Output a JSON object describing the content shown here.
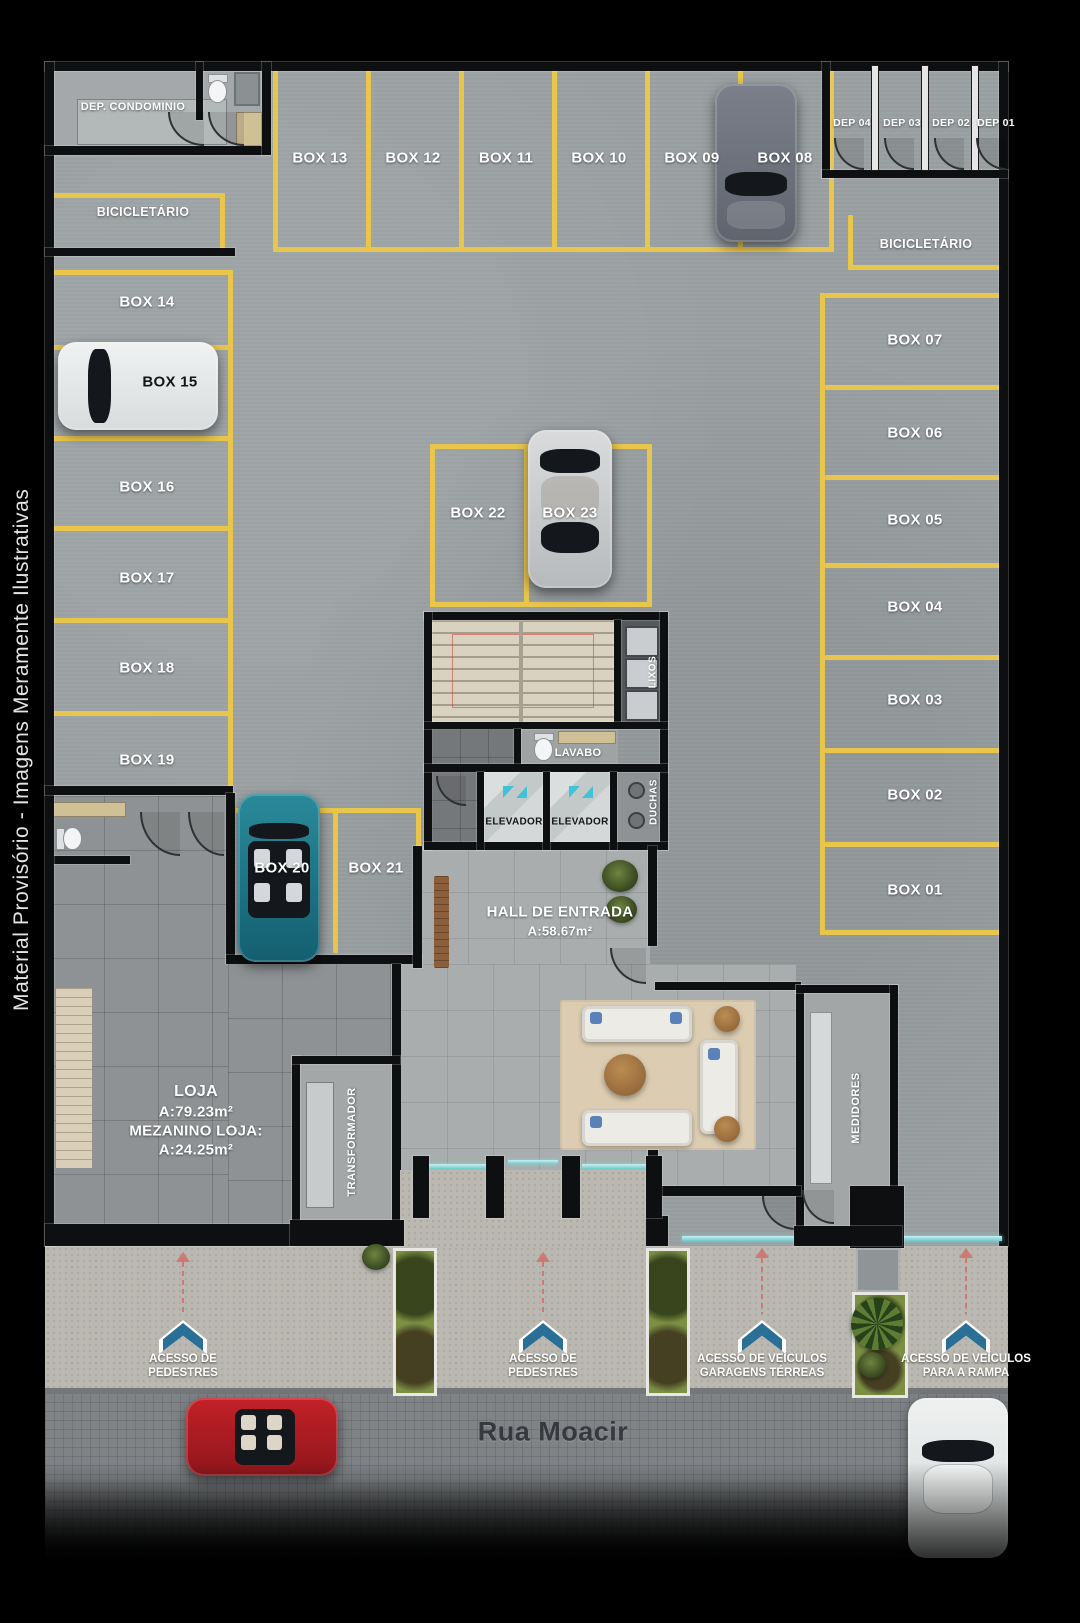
{
  "watermark": "Material Provisório - Imagens Meramente Ilustrativas",
  "street": {
    "name": "Rua Moacir"
  },
  "rooms": {
    "dep_condominio": "DEP. CONDOMINIO",
    "bicicletario_left": "BICICLETÁRIO",
    "bicicletario_right": "BICICLETÁRIO",
    "lixos": "LIXOS",
    "lavabo": "LAVABO",
    "elevador_left": "ELEVADOR",
    "elevador_right": "ELEVADOR",
    "duchas": "DUCHAS",
    "transformador": "TRANSFORMADOR",
    "medidores": "MEDIDORES",
    "hall_title": "HALL DE ENTRADA",
    "hall_area": "A:58.67m²",
    "loja_title": "LOJA",
    "loja_area": "A:79.23m²",
    "loja_mezanino": "MEZANINO LOJA:",
    "loja_mezanino_area": "A:24.25m²"
  },
  "deps": {
    "d04": "DEP 04",
    "d03": "DEP 03",
    "d02": "DEP 02",
    "d01": "DEP 01"
  },
  "boxes": {
    "b01": "BOX 01",
    "b02": "BOX 02",
    "b03": "BOX 03",
    "b04": "BOX 04",
    "b05": "BOX 05",
    "b06": "BOX 06",
    "b07": "BOX 07",
    "b08": "BOX 08",
    "b09": "BOX 09",
    "b10": "BOX 10",
    "b11": "BOX 11",
    "b12": "BOX 12",
    "b13": "BOX 13",
    "b14": "BOX 14",
    "b15": "BOX 15",
    "b16": "BOX 16",
    "b17": "BOX 17",
    "b18": "BOX 18",
    "b19": "BOX 19",
    "b20": "BOX 20",
    "b21": "BOX 21",
    "b22": "BOX 22",
    "b23": "BOX 23"
  },
  "accesses": {
    "ped1_l1": "ACESSO DE",
    "ped1_l2": "PEDESTRES",
    "ped2_l1": "ACESSO DE",
    "ped2_l2": "PEDESTRES",
    "veic1_l1": "ACESSO DE VEÍCULOS",
    "veic1_l2": "GARAGENS TÉRREAS",
    "veic2_l1": "ACESSO DE VEÍCULOS",
    "veic2_l2": "PARA A RAMPA"
  },
  "colors": {
    "line_yellow": "#e8c64b",
    "chevron_blue": "#2a6f96",
    "glass_teal": "#7fd0d4",
    "arrow_red": "#cf6f68",
    "elevator_teal": "#3fc3d6"
  }
}
